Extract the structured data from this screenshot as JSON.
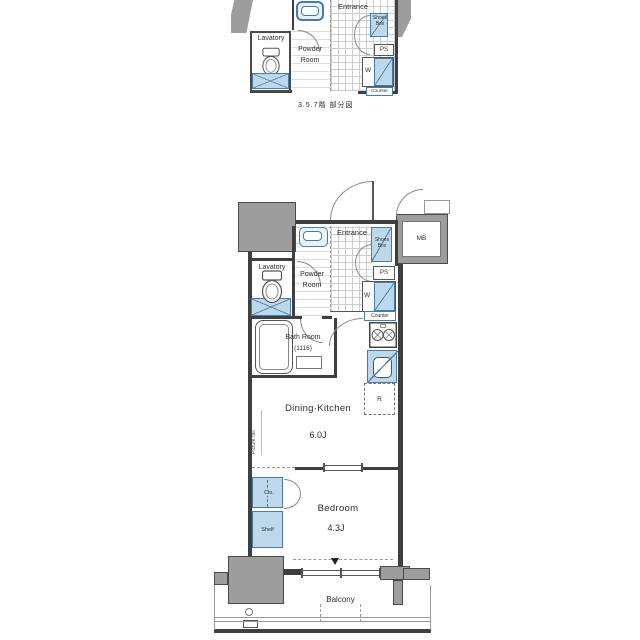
{
  "figure": {
    "type": "apartment-floor-plan"
  },
  "partial_plan": {
    "caption": "3.5.7階 部分図",
    "labels": {
      "entrance": "Entrance",
      "shoes_box": "Shoes Box",
      "ps": "PS",
      "washer": "W",
      "counter": "Counter",
      "lavatory": "Lavatory",
      "powder_line1": "Powder",
      "powder_line2": "Room"
    }
  },
  "main_plan": {
    "labels": {
      "entrance": "Entrance",
      "shoes_box": "Shoes Box",
      "meter_box": "MB",
      "ps": "PS",
      "washer": "W",
      "counter": "Counter",
      "lavatory": "Lavatory",
      "powder_line1": "Powder",
      "powder_line2": "Room",
      "bath_line1": "Bath Room",
      "bath_line2": "(1116)",
      "refrigerator": "R",
      "dining_kitchen": "Dining·Kitchen",
      "dining_kitchen_size": "6.0J",
      "picture_rail": "Picture rail",
      "closet": "Clo.",
      "shelf": "Shelf",
      "bedroom": "Bedroom",
      "bedroom_size": "4.3J",
      "balcony": "Balcony"
    }
  },
  "colors": {
    "fixture_fill": "#bcd8ea",
    "fixture_border": "#4a7aa6",
    "wall_dark": "#3f3f3f",
    "wall_gray": "#9d9d9d",
    "floor": "#ffffff",
    "text": "#2e2e2e"
  }
}
